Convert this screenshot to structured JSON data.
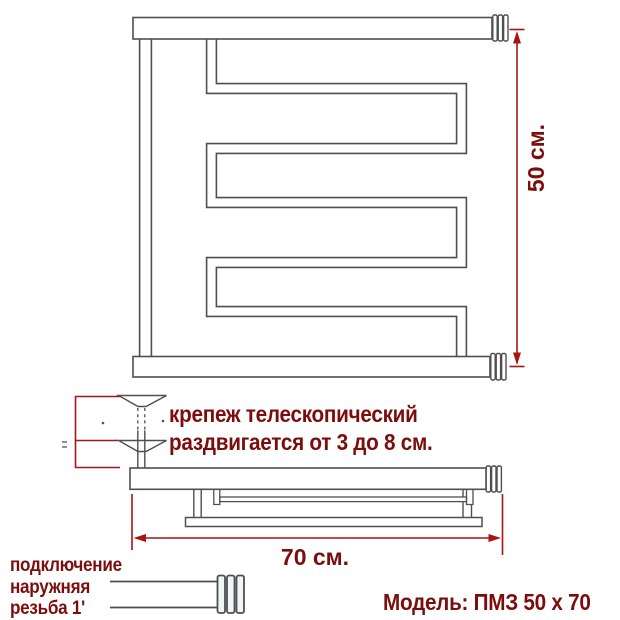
{
  "colors": {
    "accent_red": "#7c0d0d",
    "dimension_red": "#a81414",
    "line_gray": "#4f4f4f",
    "background": "#ffffff"
  },
  "front_view": {
    "height_label": "50 см."
  },
  "mount_note": {
    "line1": "крепеж телескопический",
    "line2": "раздвигается от 3 до 8 см."
  },
  "top_view": {
    "width_label": "70 см."
  },
  "connection_note": {
    "line1": "подключение",
    "line2": "наружняя",
    "line3": "резьба 1'"
  },
  "model_label": "Модель: ПМЗ 50 x 70"
}
